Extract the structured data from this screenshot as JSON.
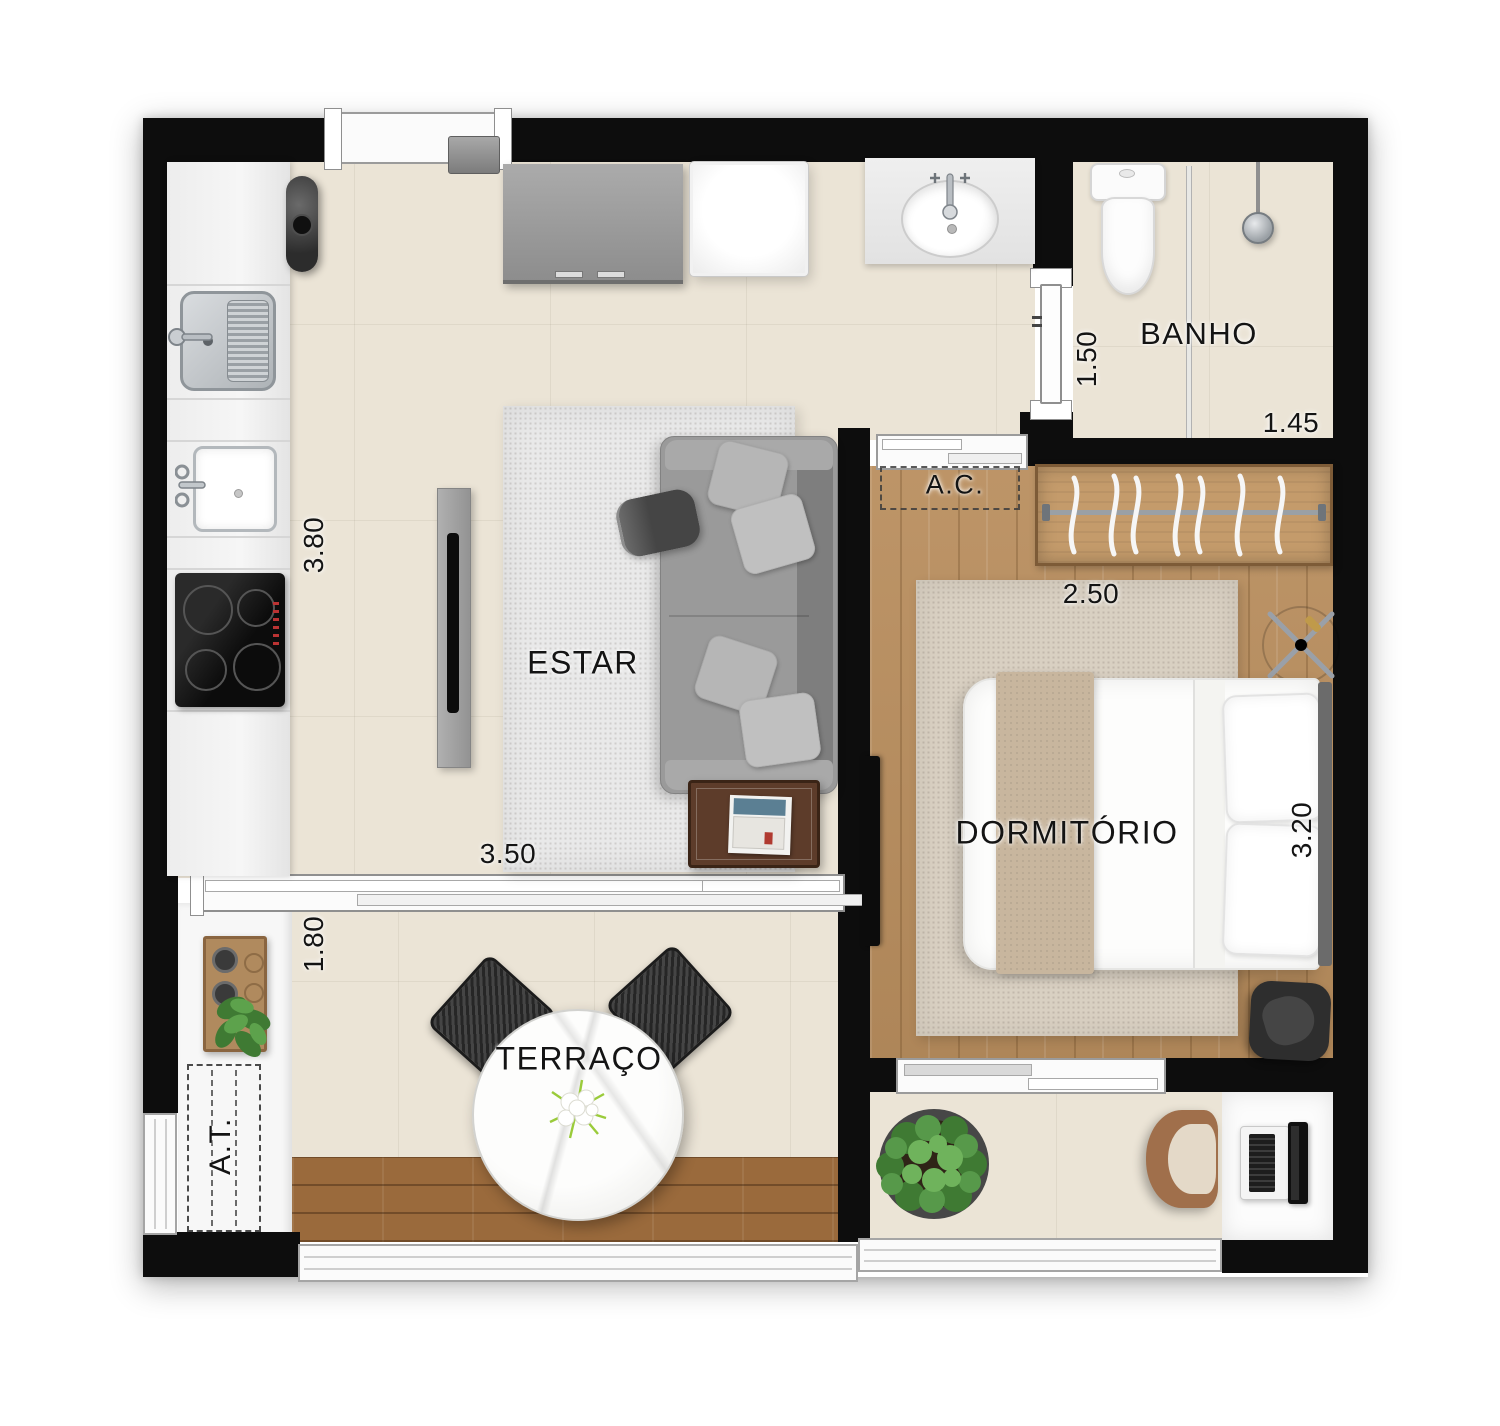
{
  "plan": {
    "type": "apartment-floor-plan",
    "rooms": {
      "estar": {
        "label": "ESTAR",
        "dim_width": "3.50",
        "dim_depth": "3.80"
      },
      "terraco": {
        "label": "TERRAÇO",
        "dim_depth": "1.80"
      },
      "dormitorio": {
        "label": "DORMITÓRIO",
        "dim_width": "2.50",
        "dim_depth": "3.20"
      },
      "banho": {
        "label": "BANHO",
        "dim_width": "1.45",
        "dim_depth": "1.50"
      }
    },
    "zones": {
      "ac": {
        "label": "A.C."
      },
      "at": {
        "label": "A.T."
      }
    },
    "colors": {
      "wall": "#0d0d0d",
      "tile_floor": "#ebe4d6",
      "wood_floor": "#b98e5e",
      "deck_floor": "#9a6a3c",
      "kitchen_counter": "#f3f3f3",
      "living_rug": "#e9e9e9",
      "bedroom_rug": "#d9d0c2",
      "sofa_grey": "#9a9a9a",
      "table_wood": "#5d3c2a",
      "plant_green": "#4e8f3f",
      "chair_brown": "#a06f4b"
    },
    "furniture_icons": [
      "kitchen-sink",
      "laundry-sink",
      "cooktop",
      "decor-vase",
      "entry-cabinet",
      "refrigerator",
      "tv-panel",
      "sofa",
      "ottoman",
      "side-table",
      "living-rug",
      "dining-table",
      "flower-centerpiece",
      "outdoor-chair",
      "tray-shelf",
      "service-unit",
      "washbasin",
      "toilet",
      "shower-head",
      "glass-partition",
      "wardrobe-hangers",
      "bed",
      "bed-runner",
      "ceiling-fan",
      "bedroom-tv",
      "armchair",
      "bedroom-rug",
      "potted-plant",
      "office-chair",
      "desk",
      "laptop",
      "sliding-door",
      "entry-door",
      "window",
      "railing"
    ]
  }
}
